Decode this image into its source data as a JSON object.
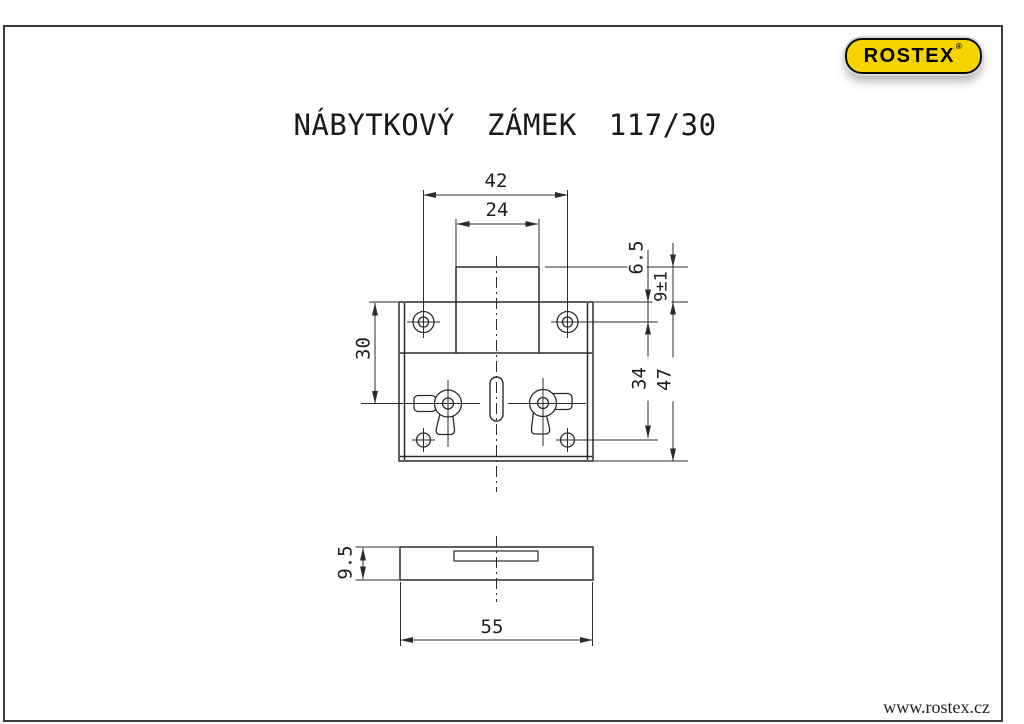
{
  "page": {
    "title": "NÁBYTKOVÝ ZÁMEK 117/30",
    "website": "www.rostex.cz"
  },
  "logo": {
    "brand": "ROSTEX",
    "registered": "®",
    "fill_color": "#f4d300",
    "text_color": "#000000"
  },
  "colors": {
    "line": "#2b2b2b",
    "frame": "#3c3c3c"
  },
  "dims": {
    "screw_hole_spacing_width": "42",
    "case_width": "24",
    "top_edge_to_screw_holes": "6.5",
    "case_lip_height": "9±1",
    "top_edge_to_nut_axis": "30",
    "screw_hole_spacing_height": "34",
    "plate_height": "47",
    "plate_thickness": "9.5",
    "plate_width": "55"
  }
}
